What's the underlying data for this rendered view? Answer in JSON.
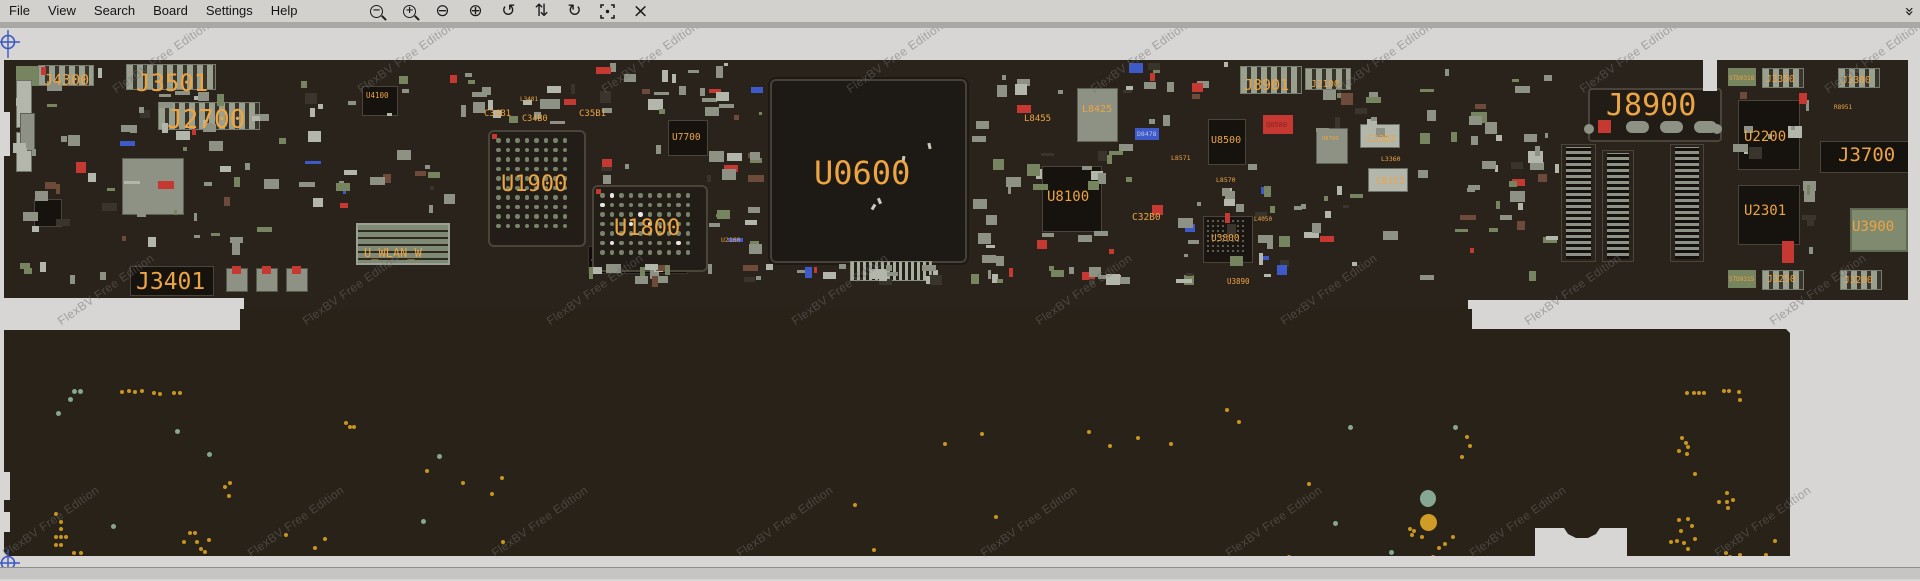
{
  "window": {
    "menu_items": [
      "File",
      "View",
      "Search",
      "Board",
      "Settings",
      "Help"
    ],
    "toolbar_icons": [
      {
        "name": "magnify-out-icon",
        "kind": "mag",
        "sign": "−"
      },
      {
        "name": "magnify-in-icon",
        "kind": "mag",
        "sign": "+"
      },
      {
        "name": "zoom-out-circle-icon",
        "kind": "glyph",
        "glyph": "⊖"
      },
      {
        "name": "zoom-in-circle-icon",
        "kind": "glyph",
        "glyph": "⊕"
      },
      {
        "name": "rotate-ccw-icon",
        "kind": "glyph",
        "glyph": "↺"
      },
      {
        "name": "flip-vertical-icon",
        "kind": "glyph",
        "glyph": "⇅"
      },
      {
        "name": "rotate-cw-icon",
        "kind": "glyph",
        "glyph": "↻"
      },
      {
        "name": "center-target-icon",
        "kind": "target"
      },
      {
        "name": "close-icon",
        "kind": "glyph",
        "glyph": "×"
      }
    ],
    "overflow_icon": "»"
  },
  "watermark": {
    "text": "FlexBV Free Edition",
    "rows": [
      {
        "y": 68,
        "x0": 118
      },
      {
        "y": 300,
        "x0": 63
      },
      {
        "y": 532,
        "x0": 8
      }
    ],
    "x_step": 244.5,
    "count_per_row": 8
  },
  "colors": {
    "board_top": "#2a231b",
    "board_bottom": "#282218",
    "label_orange": "#eda443",
    "component_gray": "#8d9284",
    "component_light": "#b3b7ab",
    "pad_green": "#76855f",
    "chip_dark": "#16120e",
    "accent_red": "#c63832",
    "accent_brown": "#6d4a3a",
    "accent_blue": "#3d5ac8",
    "via_yellow": "#c9951f",
    "via_teal": "#87a795",
    "compass_blue": "#3b57c4"
  },
  "board_top": {
    "labels": [
      {
        "text": "J4300",
        "x": 44,
        "y": 45,
        "fs": 15
      },
      {
        "text": "J3501",
        "x": 136,
        "y": 43,
        "fs": 24
      },
      {
        "text": "J2700",
        "x": 167,
        "y": 79,
        "fs": 26
      },
      {
        "text": "U4100",
        "x": 366,
        "y": 64,
        "fs": 7.5
      },
      {
        "text": "L3401",
        "x": 520,
        "y": 69,
        "fs": 6
      },
      {
        "text": "C34B1",
        "x": 484,
        "y": 82,
        "fs": 9
      },
      {
        "text": "C34B0",
        "x": 522,
        "y": 87,
        "fs": 8.5
      },
      {
        "text": "C35B1",
        "x": 579,
        "y": 82,
        "fs": 9
      },
      {
        "text": "U1900",
        "x": 501,
        "y": 146,
        "fs": 22
      },
      {
        "text": "U1800",
        "x": 614,
        "y": 190,
        "fs": 22
      },
      {
        "text": "U_WLAN_W",
        "x": 364,
        "y": 219,
        "fs": 12
      },
      {
        "text": "J3401",
        "x": 136,
        "y": 243,
        "fs": 23
      },
      {
        "text": "U7700",
        "x": 672,
        "y": 105,
        "fs": 9.5
      },
      {
        "text": "U2160",
        "x": 721,
        "y": 209,
        "fs": 6.5
      },
      {
        "text": "U0600",
        "x": 814,
        "y": 129,
        "fs": 32
      },
      {
        "text": "L8455",
        "x": 1024,
        "y": 87,
        "fs": 9
      },
      {
        "text": "L8425",
        "x": 1082,
        "y": 77,
        "fs": 10
      },
      {
        "text": "D8478",
        "x": 1137,
        "y": 103,
        "fs": 6.5,
        "color": "#b8c4e8"
      },
      {
        "text": "U8100",
        "x": 1047,
        "y": 162,
        "fs": 14
      },
      {
        "text": "L8571",
        "x": 1171,
        "y": 127,
        "fs": 6.5
      },
      {
        "text": "U8500",
        "x": 1211,
        "y": 108,
        "fs": 10
      },
      {
        "text": "L8570",
        "x": 1216,
        "y": 149,
        "fs": 6.5
      },
      {
        "text": "C32B0",
        "x": 1132,
        "y": 185,
        "fs": 9.5
      },
      {
        "text": "U3800",
        "x": 1211,
        "y": 206,
        "fs": 9.5
      },
      {
        "text": "L4050",
        "x": 1254,
        "y": 189,
        "fs": 6
      },
      {
        "text": "U3890",
        "x": 1227,
        "y": 250,
        "fs": 7.5
      },
      {
        "text": "J8901",
        "x": 1244,
        "y": 50,
        "fs": 15
      },
      {
        "text": "J2100",
        "x": 1311,
        "y": 52,
        "fs": 9.5
      },
      {
        "text": "Q8580",
        "x": 1266,
        "y": 94,
        "fs": 7,
        "color": "#8a2420"
      },
      {
        "text": "U8700",
        "x": 1322,
        "y": 109,
        "fs": 5.5
      },
      {
        "text": "C33B2",
        "x": 1367,
        "y": 107,
        "fs": 9.5
      },
      {
        "text": "L3360",
        "x": 1381,
        "y": 128,
        "fs": 6.5
      },
      {
        "text": "C81C2",
        "x": 1376,
        "y": 149,
        "fs": 9.5
      },
      {
        "text": "J8900",
        "x": 1606,
        "y": 63,
        "fs": 30
      },
      {
        "text": "STD9318",
        "x": 1729,
        "y": 48,
        "fs": 6
      },
      {
        "text": "J3350",
        "x": 1766,
        "y": 47,
        "fs": 9.5
      },
      {
        "text": "J3300",
        "x": 1842,
        "y": 48,
        "fs": 9.5
      },
      {
        "text": "R8951",
        "x": 1834,
        "y": 77,
        "fs": 6
      },
      {
        "text": "U2200",
        "x": 1744,
        "y": 102,
        "fs": 14
      },
      {
        "text": "J3700",
        "x": 1838,
        "y": 118,
        "fs": 19
      },
      {
        "text": "U2301",
        "x": 1744,
        "y": 176,
        "fs": 14
      },
      {
        "text": "U3900",
        "x": 1852,
        "y": 192,
        "fs": 14
      },
      {
        "text": "STD9315",
        "x": 1729,
        "y": 249,
        "fs": 6
      },
      {
        "text": "J3250",
        "x": 1767,
        "y": 247,
        "fs": 9.5
      },
      {
        "text": "J3200",
        "x": 1844,
        "y": 248,
        "fs": 9.5
      }
    ],
    "major_components": [
      {
        "x": 16,
        "y": 38,
        "w": 26,
        "h": 20,
        "t": "pad"
      },
      {
        "x": 38,
        "y": 37,
        "w": 54,
        "h": 19,
        "t": "conn"
      },
      {
        "x": 126,
        "y": 36,
        "w": 88,
        "h": 24,
        "t": "conn"
      },
      {
        "x": 158,
        "y": 74,
        "w": 100,
        "h": 26,
        "t": "conn"
      },
      {
        "x": 16,
        "y": 52,
        "w": 14,
        "h": 46,
        "t": "light"
      },
      {
        "x": 16,
        "y": 104,
        "w": 14,
        "h": 38,
        "t": "light"
      },
      {
        "x": 20,
        "y": 85,
        "w": 13,
        "h": 36,
        "t": "gray"
      },
      {
        "x": 122,
        "y": 130,
        "w": 60,
        "h": 55,
        "t": "gray"
      },
      {
        "x": 34,
        "y": 171,
        "w": 26,
        "h": 26,
        "t": "dark"
      },
      {
        "x": 362,
        "y": 58,
        "w": 34,
        "h": 28,
        "t": "dark"
      },
      {
        "x": 356,
        "y": 195,
        "w": 90,
        "h": 38,
        "t": "wlan"
      },
      {
        "x": 588,
        "y": 218,
        "w": 98,
        "h": 26,
        "t": "dotconn"
      },
      {
        "x": 488,
        "y": 102,
        "w": 94,
        "h": 113,
        "t": "bga"
      },
      {
        "x": 592,
        "y": 157,
        "w": 112,
        "h": 83,
        "t": "bga"
      },
      {
        "x": 768,
        "y": 49,
        "w": 197,
        "h": 184,
        "t": "bigchip"
      },
      {
        "x": 668,
        "y": 92,
        "w": 38,
        "h": 34,
        "t": "dark"
      },
      {
        "x": 1042,
        "y": 138,
        "w": 58,
        "h": 64,
        "t": "dark"
      },
      {
        "x": 1208,
        "y": 91,
        "w": 36,
        "h": 44,
        "t": "dark"
      },
      {
        "x": 1203,
        "y": 188,
        "w": 48,
        "h": 45,
        "t": "bgas"
      },
      {
        "x": 1077,
        "y": 60,
        "w": 39,
        "h": 52,
        "t": "gray"
      },
      {
        "x": 1135,
        "y": 100,
        "w": 24,
        "h": 12,
        "t": "blue"
      },
      {
        "x": 1263,
        "y": 87,
        "w": 30,
        "h": 19,
        "t": "red"
      },
      {
        "x": 1738,
        "y": 72,
        "w": 60,
        "h": 68,
        "t": "dark"
      },
      {
        "x": 1738,
        "y": 157,
        "w": 60,
        "h": 58,
        "t": "dark"
      },
      {
        "x": 1820,
        "y": 113,
        "w": 92,
        "h": 30,
        "t": "dark"
      },
      {
        "x": 1850,
        "y": 180,
        "w": 54,
        "h": 40,
        "t": "green"
      },
      {
        "x": 1588,
        "y": 60,
        "w": 130,
        "h": 50,
        "t": "j8900"
      },
      {
        "x": 1602,
        "y": 122,
        "w": 22,
        "h": 106,
        "t": "vconn"
      },
      {
        "x": 1670,
        "y": 116,
        "w": 24,
        "h": 112,
        "t": "vconn"
      },
      {
        "x": 1561,
        "y": 116,
        "w": 25,
        "h": 112,
        "t": "vconn"
      },
      {
        "x": 1728,
        "y": 40,
        "w": 28,
        "h": 18,
        "t": "pad"
      },
      {
        "x": 1762,
        "y": 40,
        "w": 40,
        "h": 18,
        "t": "conn"
      },
      {
        "x": 1838,
        "y": 40,
        "w": 40,
        "h": 18,
        "t": "conn"
      },
      {
        "x": 1728,
        "y": 242,
        "w": 28,
        "h": 18,
        "t": "pad"
      },
      {
        "x": 1762,
        "y": 242,
        "w": 40,
        "h": 18,
        "t": "conn"
      },
      {
        "x": 1840,
        "y": 242,
        "w": 40,
        "h": 18,
        "t": "conn"
      },
      {
        "x": 130,
        "y": 238,
        "w": 82,
        "h": 28,
        "t": "dark"
      },
      {
        "x": 226,
        "y": 240,
        "w": 20,
        "h": 22,
        "t": "capr"
      },
      {
        "x": 256,
        "y": 240,
        "w": 20,
        "h": 22,
        "t": "capr"
      },
      {
        "x": 286,
        "y": 240,
        "w": 20,
        "h": 22,
        "t": "capr"
      },
      {
        "x": 1240,
        "y": 38,
        "w": 60,
        "h": 26,
        "t": "conn"
      },
      {
        "x": 1305,
        "y": 40,
        "w": 44,
        "h": 20,
        "t": "conn"
      },
      {
        "x": 850,
        "y": 233,
        "w": 80,
        "h": 18,
        "t": "hconn"
      },
      {
        "x": 1782,
        "y": 213,
        "w": 12,
        "h": 22,
        "t": "red"
      },
      {
        "x": 1316,
        "y": 100,
        "w": 30,
        "h": 34,
        "t": "gray"
      },
      {
        "x": 1360,
        "y": 96,
        "w": 38,
        "h": 22,
        "t": "light"
      },
      {
        "x": 1368,
        "y": 140,
        "w": 38,
        "h": 22,
        "t": "light"
      }
    ],
    "clusters": [
      {
        "x": 8,
        "y": 34,
        "w": 110,
        "h": 230,
        "n": 26
      },
      {
        "x": 120,
        "y": 58,
        "w": 170,
        "h": 70,
        "n": 22
      },
      {
        "x": 120,
        "y": 128,
        "w": 170,
        "h": 112,
        "n": 20
      },
      {
        "x": 290,
        "y": 34,
        "w": 170,
        "h": 158,
        "n": 26
      },
      {
        "x": 450,
        "y": 34,
        "w": 135,
        "h": 64,
        "n": 18
      },
      {
        "x": 585,
        "y": 34,
        "w": 180,
        "h": 58,
        "n": 20
      },
      {
        "x": 600,
        "y": 116,
        "w": 165,
        "h": 44,
        "n": 10
      },
      {
        "x": 706,
        "y": 36,
        "w": 60,
        "h": 198,
        "n": 16
      },
      {
        "x": 970,
        "y": 34,
        "w": 105,
        "h": 224,
        "n": 26
      },
      {
        "x": 1075,
        "y": 115,
        "w": 128,
        "h": 118,
        "n": 18
      },
      {
        "x": 1120,
        "y": 34,
        "w": 118,
        "h": 68,
        "n": 14
      },
      {
        "x": 1215,
        "y": 122,
        "w": 88,
        "h": 118,
        "n": 16
      },
      {
        "x": 1255,
        "y": 155,
        "w": 145,
        "h": 98,
        "n": 18
      },
      {
        "x": 1300,
        "y": 62,
        "w": 98,
        "h": 52,
        "n": 12
      },
      {
        "x": 1405,
        "y": 130,
        "w": 150,
        "h": 138,
        "n": 16
      },
      {
        "x": 1420,
        "y": 34,
        "w": 140,
        "h": 88,
        "n": 14
      },
      {
        "x": 1488,
        "y": 100,
        "w": 72,
        "h": 128,
        "n": 12
      },
      {
        "x": 585,
        "y": 236,
        "w": 430,
        "h": 24,
        "n": 34
      },
      {
        "x": 1030,
        "y": 238,
        "w": 168,
        "h": 20,
        "n": 12
      },
      {
        "x": 1732,
        "y": 62,
        "w": 78,
        "h": 76,
        "n": 10
      },
      {
        "x": 1800,
        "y": 150,
        "w": 18,
        "h": 78,
        "n": 6
      }
    ],
    "specks": [
      {
        "x": 902,
        "y": 128
      },
      {
        "x": 872,
        "y": 176
      },
      {
        "x": 878,
        "y": 170
      },
      {
        "x": 928,
        "y": 115
      }
    ]
  },
  "board_bottom": {
    "big_dots": [
      {
        "x": 1420,
        "y": 462,
        "w": 16,
        "h": 17,
        "c": "t"
      },
      {
        "x": 1420,
        "y": 486,
        "w": 17,
        "h": 17,
        "c": "y"
      }
    ],
    "teal_dots": [
      [
        72,
        361
      ],
      [
        78,
        361
      ],
      [
        68,
        369
      ],
      [
        56,
        383
      ],
      [
        175,
        401
      ],
      [
        207,
        424
      ],
      [
        111,
        496
      ],
      [
        421,
        491
      ],
      [
        437,
        426
      ],
      [
        1348,
        397
      ],
      [
        1453,
        397
      ],
      [
        1333,
        493
      ],
      [
        1389,
        522
      ]
    ],
    "yellow_dots": [
      [
        120,
        362
      ],
      [
        127,
        361
      ],
      [
        133,
        362
      ],
      [
        140,
        361
      ],
      [
        152,
        363
      ],
      [
        158,
        364
      ],
      [
        172,
        363
      ],
      [
        178,
        363
      ],
      [
        344,
        393
      ],
      [
        348,
        397
      ],
      [
        352,
        397
      ],
      [
        228,
        453
      ],
      [
        223,
        457
      ],
      [
        227,
        466
      ],
      [
        54,
        484
      ],
      [
        59,
        492
      ],
      [
        59,
        499
      ],
      [
        54,
        507
      ],
      [
        59,
        507
      ],
      [
        64,
        507
      ],
      [
        54,
        515
      ],
      [
        59,
        515
      ],
      [
        72,
        523
      ],
      [
        79,
        523
      ],
      [
        78,
        531
      ],
      [
        182,
        512
      ],
      [
        188,
        503
      ],
      [
        193,
        503
      ],
      [
        195,
        512
      ],
      [
        199,
        519
      ],
      [
        203,
        522
      ],
      [
        203,
        530
      ],
      [
        207,
        510
      ],
      [
        110,
        532
      ],
      [
        116,
        532
      ],
      [
        135,
        532
      ],
      [
        143,
        532
      ],
      [
        150,
        532
      ],
      [
        171,
        532
      ],
      [
        177,
        532
      ],
      [
        284,
        505
      ],
      [
        313,
        518
      ],
      [
        323,
        509
      ],
      [
        414,
        531
      ],
      [
        413,
        534
      ],
      [
        425,
        441
      ],
      [
        461,
        453
      ],
      [
        490,
        464
      ],
      [
        500,
        448
      ],
      [
        501,
        512
      ],
      [
        853,
        475
      ],
      [
        943,
        414
      ],
      [
        980,
        404
      ],
      [
        994,
        487
      ],
      [
        1087,
        402
      ],
      [
        1108,
        416
      ],
      [
        1136,
        408
      ],
      [
        1169,
        414
      ],
      [
        1225,
        380
      ],
      [
        1237,
        392
      ],
      [
        930,
        549
      ],
      [
        967,
        541
      ],
      [
        872,
        520
      ],
      [
        1287,
        527
      ],
      [
        1307,
        454
      ],
      [
        1408,
        499
      ],
      [
        1412,
        501
      ],
      [
        1410,
        505
      ],
      [
        1420,
        507
      ],
      [
        1451,
        507
      ],
      [
        1443,
        514
      ],
      [
        1437,
        518
      ],
      [
        1431,
        527
      ],
      [
        1465,
        407
      ],
      [
        1468,
        416
      ],
      [
        1460,
        427
      ],
      [
        1685,
        363
      ],
      [
        1692,
        363
      ],
      [
        1697,
        363
      ],
      [
        1702,
        363
      ],
      [
        1722,
        361
      ],
      [
        1727,
        361
      ],
      [
        1737,
        362
      ],
      [
        1738,
        370
      ],
      [
        1680,
        408
      ],
      [
        1684,
        413
      ],
      [
        1686,
        417
      ],
      [
        1677,
        421
      ],
      [
        1685,
        424
      ],
      [
        1693,
        444
      ],
      [
        1725,
        463
      ],
      [
        1717,
        472
      ],
      [
        1725,
        472
      ],
      [
        1731,
        470
      ],
      [
        1726,
        478
      ],
      [
        1677,
        490
      ],
      [
        1686,
        489
      ],
      [
        1690,
        496
      ],
      [
        1679,
        501
      ],
      [
        1675,
        511
      ],
      [
        1682,
        513
      ],
      [
        1693,
        509
      ],
      [
        1686,
        519
      ],
      [
        1669,
        512
      ],
      [
        1678,
        533
      ],
      [
        1684,
        533
      ],
      [
        1690,
        533
      ],
      [
        1697,
        534
      ],
      [
        1703,
        534
      ],
      [
        1724,
        523
      ],
      [
        1728,
        527
      ],
      [
        1738,
        525
      ],
      [
        1727,
        534
      ],
      [
        1773,
        511
      ],
      [
        1764,
        525
      ],
      [
        1762,
        531
      ],
      [
        1762,
        536
      ]
    ]
  }
}
